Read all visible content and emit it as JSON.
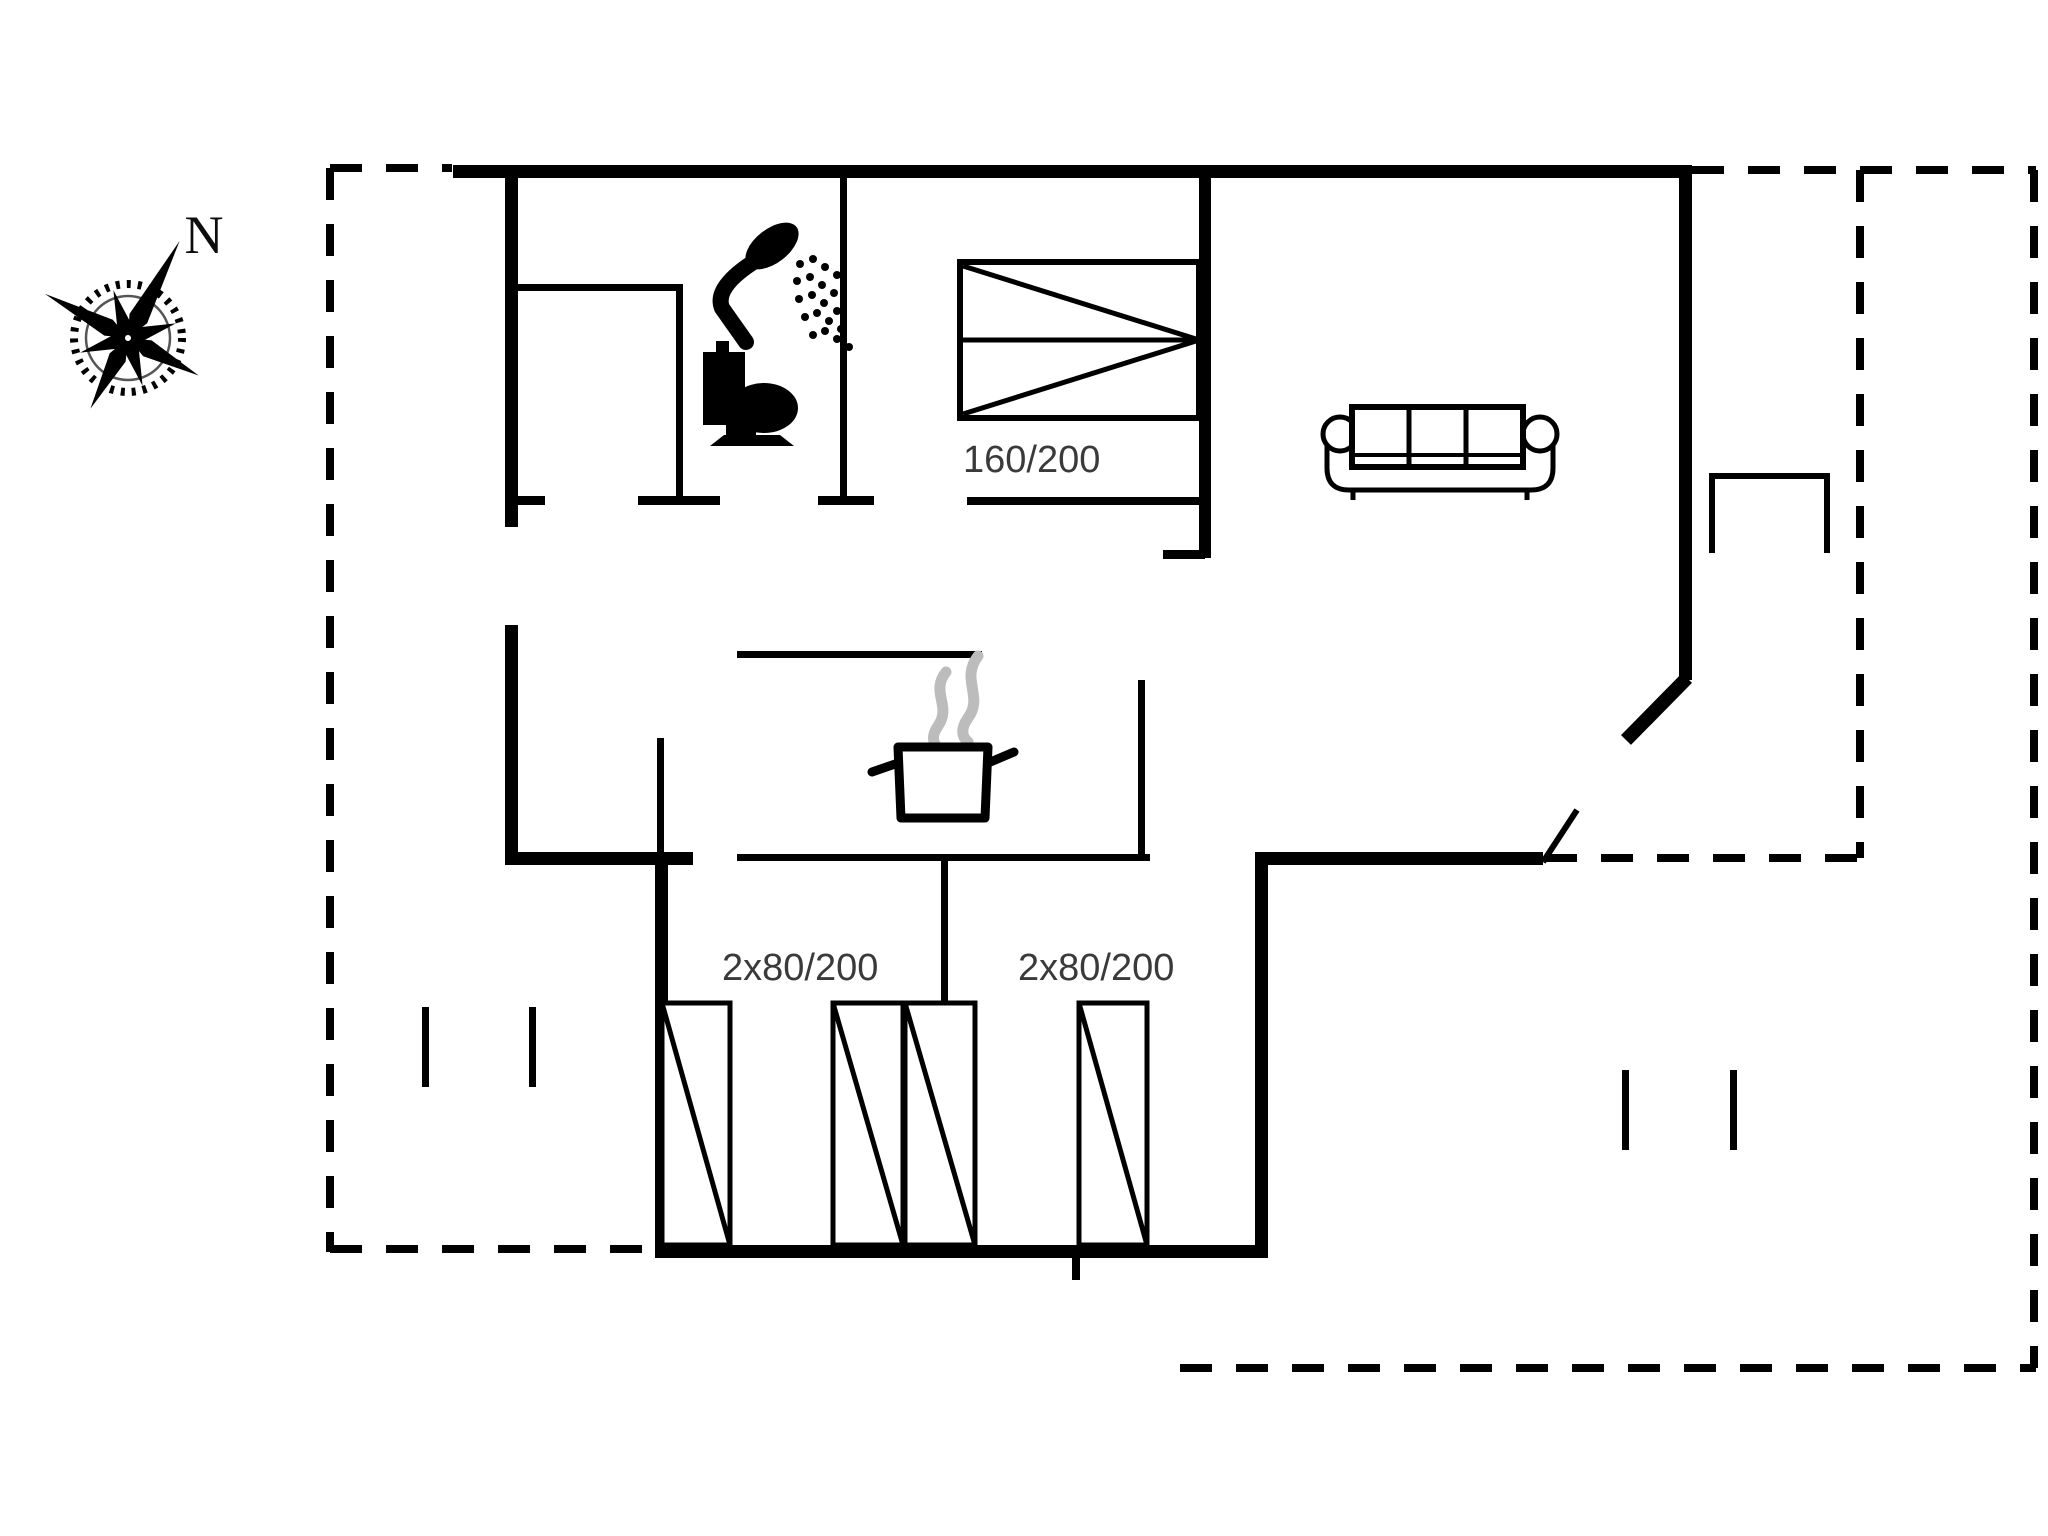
{
  "compass": {
    "label": "N"
  },
  "furniture": {
    "bed": {
      "label": "160/200"
    },
    "wardrobe_left": {
      "label": "2x80/200"
    },
    "wardrobe_right": {
      "label": "2x80/200"
    }
  },
  "colors": {
    "line": "#000000",
    "steam": "#bcbcbc",
    "dimension_text": "#3a3a3a",
    "background": "#ffffff"
  },
  "icons": {
    "compass": "compass-rose-icon",
    "shower": "shower-icon",
    "toilet": "toilet-icon",
    "pot": "cooking-pot-icon",
    "bed": "double-bed-icon",
    "sofa": "sofa-icon",
    "wardrobe": "wardrobe-icon",
    "bench": "terrace-bench-icon",
    "door": "open-door-leaf-icon"
  }
}
